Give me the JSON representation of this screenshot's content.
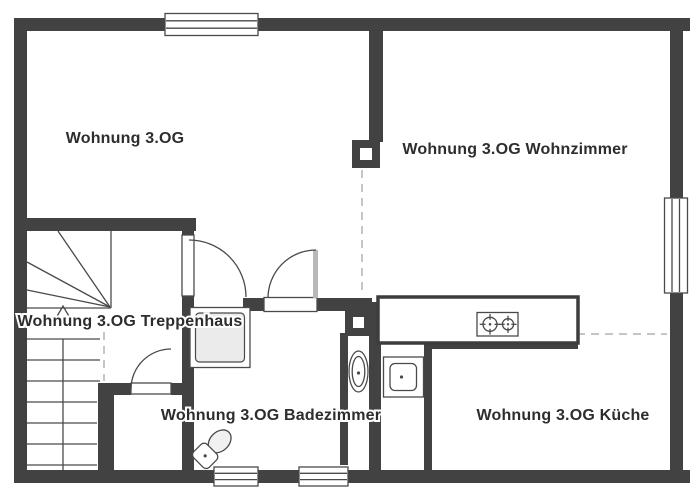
{
  "plan": {
    "type": "floor-plan",
    "rooms": [
      {
        "id": "apartment-hall",
        "label": "Wohnung 3.OG"
      },
      {
        "id": "living-room",
        "label": "Wohnung 3.OG Wohnzimmer"
      },
      {
        "id": "stairwell",
        "label": "Wohnung 3.OG Treppenhaus"
      },
      {
        "id": "bathroom",
        "label": "Wohnung 3.OG Badezimmer"
      },
      {
        "id": "kitchen",
        "label": "Wohnung 3.OG Küche"
      }
    ],
    "icons": [
      "stairs-icon",
      "direction-arrow-icon",
      "door-swing-icon",
      "window-icon",
      "stove-icon",
      "sink-icon",
      "shower-icon",
      "toilet-icon",
      "washbasin-icon",
      "shaft-icon"
    ],
    "colors": {
      "wall": "#424242",
      "line": "#4a4a4a",
      "dashed_boundary": "#c5c5c5",
      "fixture_fill": "#ebebeb",
      "door_leaf": "#b8b8b8",
      "text": "#2d2d2d",
      "background": "#ffffff"
    }
  }
}
